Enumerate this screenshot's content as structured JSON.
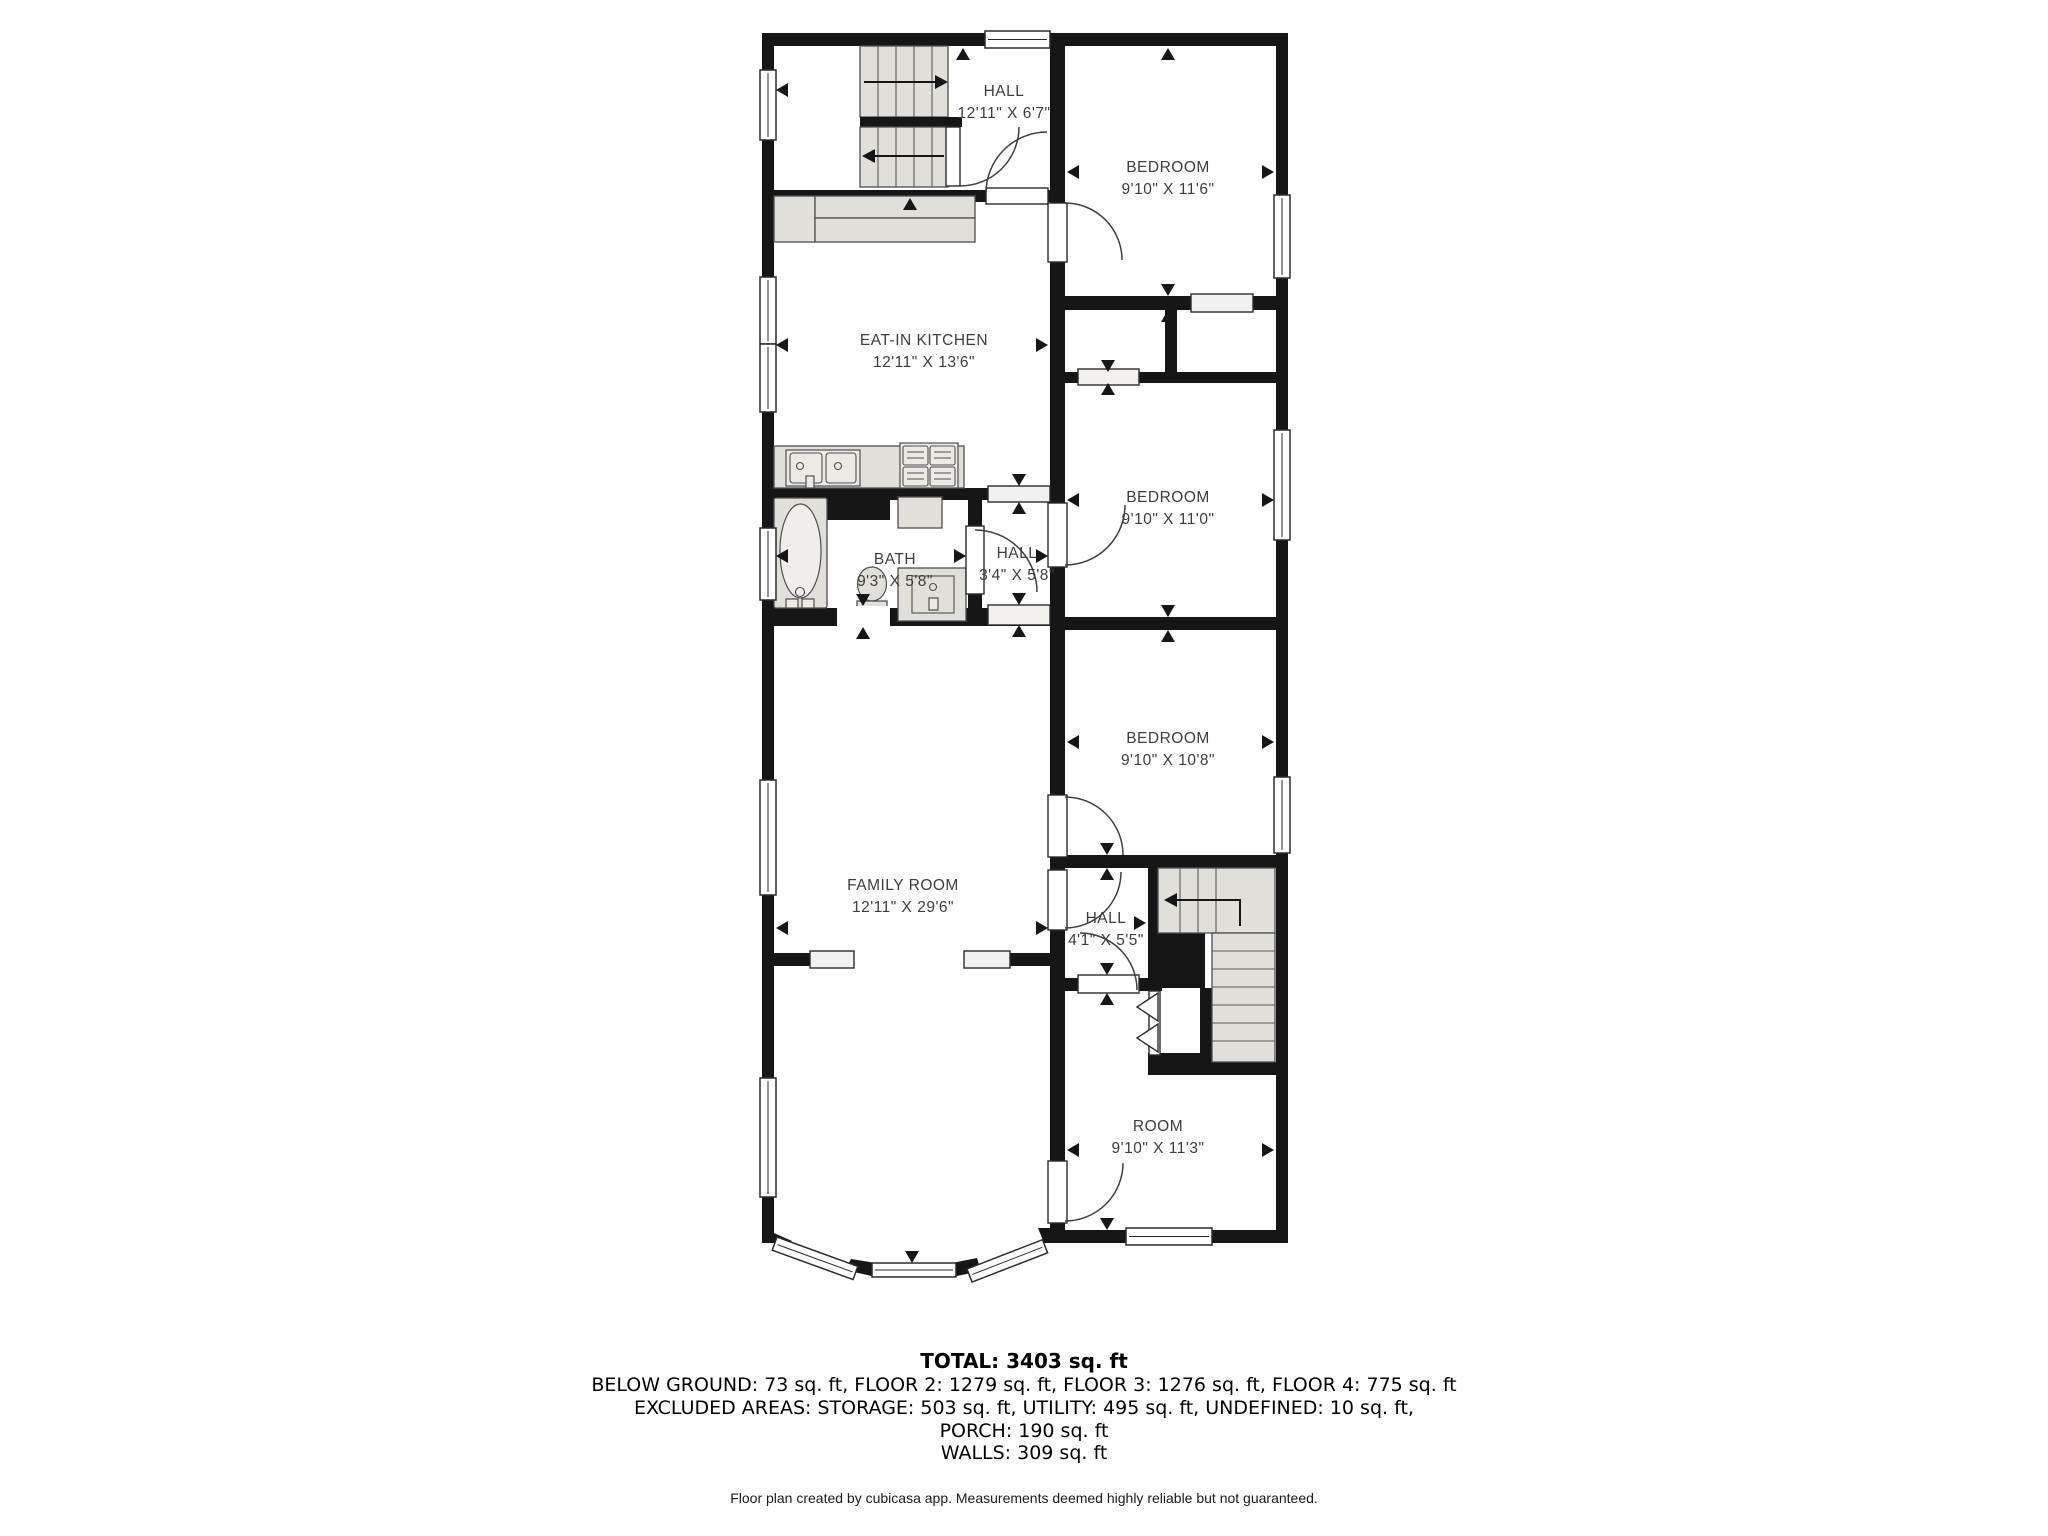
{
  "plan": {
    "rooms": [
      {
        "id": "hall-top",
        "name": "HALL",
        "dims": "12'11\" X 6'7\""
      },
      {
        "id": "bedroom-1",
        "name": "BEDROOM",
        "dims": "9'10\" X 11'6\""
      },
      {
        "id": "kitchen",
        "name": "EAT-IN KITCHEN",
        "dims": "12'11\" X 13'6\""
      },
      {
        "id": "bedroom-2",
        "name": "BEDROOM",
        "dims": "9'10\" X 11'0\""
      },
      {
        "id": "bath",
        "name": "BATH",
        "dims": "9'3\" X 5'8\""
      },
      {
        "id": "hall-mid",
        "name": "HALL",
        "dims": "3'4\" X 5'8\""
      },
      {
        "id": "bedroom-3",
        "name": "BEDROOM",
        "dims": "9'10\" X 10'8\""
      },
      {
        "id": "family-room",
        "name": "FAMILY ROOM",
        "dims": "12'11\" X 29'6\""
      },
      {
        "id": "hall-bottom",
        "name": "HALL",
        "dims": "4'1\" X 5'5\""
      },
      {
        "id": "room",
        "name": "ROOM",
        "dims": "9'10\" X 11'3\""
      }
    ]
  },
  "summary": {
    "total": "TOTAL: 3403 sq. ft",
    "line1": "BELOW GROUND: 73 sq. ft, FLOOR 2: 1279 sq. ft, FLOOR 3: 1276 sq. ft, FLOOR 4: 775 sq. ft",
    "line2": "EXCLUDED AREAS: STORAGE: 503 sq. ft, UTILITY: 495 sq. ft, UNDEFINED: 10 sq. ft,",
    "line3": "PORCH: 190 sq. ft",
    "line4": "WALLS: 309 sq. ft"
  },
  "footer": {
    "text": "Floor plan created by cubicasa app. Measurements deemed highly reliable but not guaranteed."
  },
  "colors": {
    "wall": "#161616",
    "fixture_fill": "#e1dfd9",
    "fixture_stroke": "#4f4f4f",
    "label_text": "#3d3d3d",
    "summary_text": "#000000",
    "background": "#ffffff"
  }
}
